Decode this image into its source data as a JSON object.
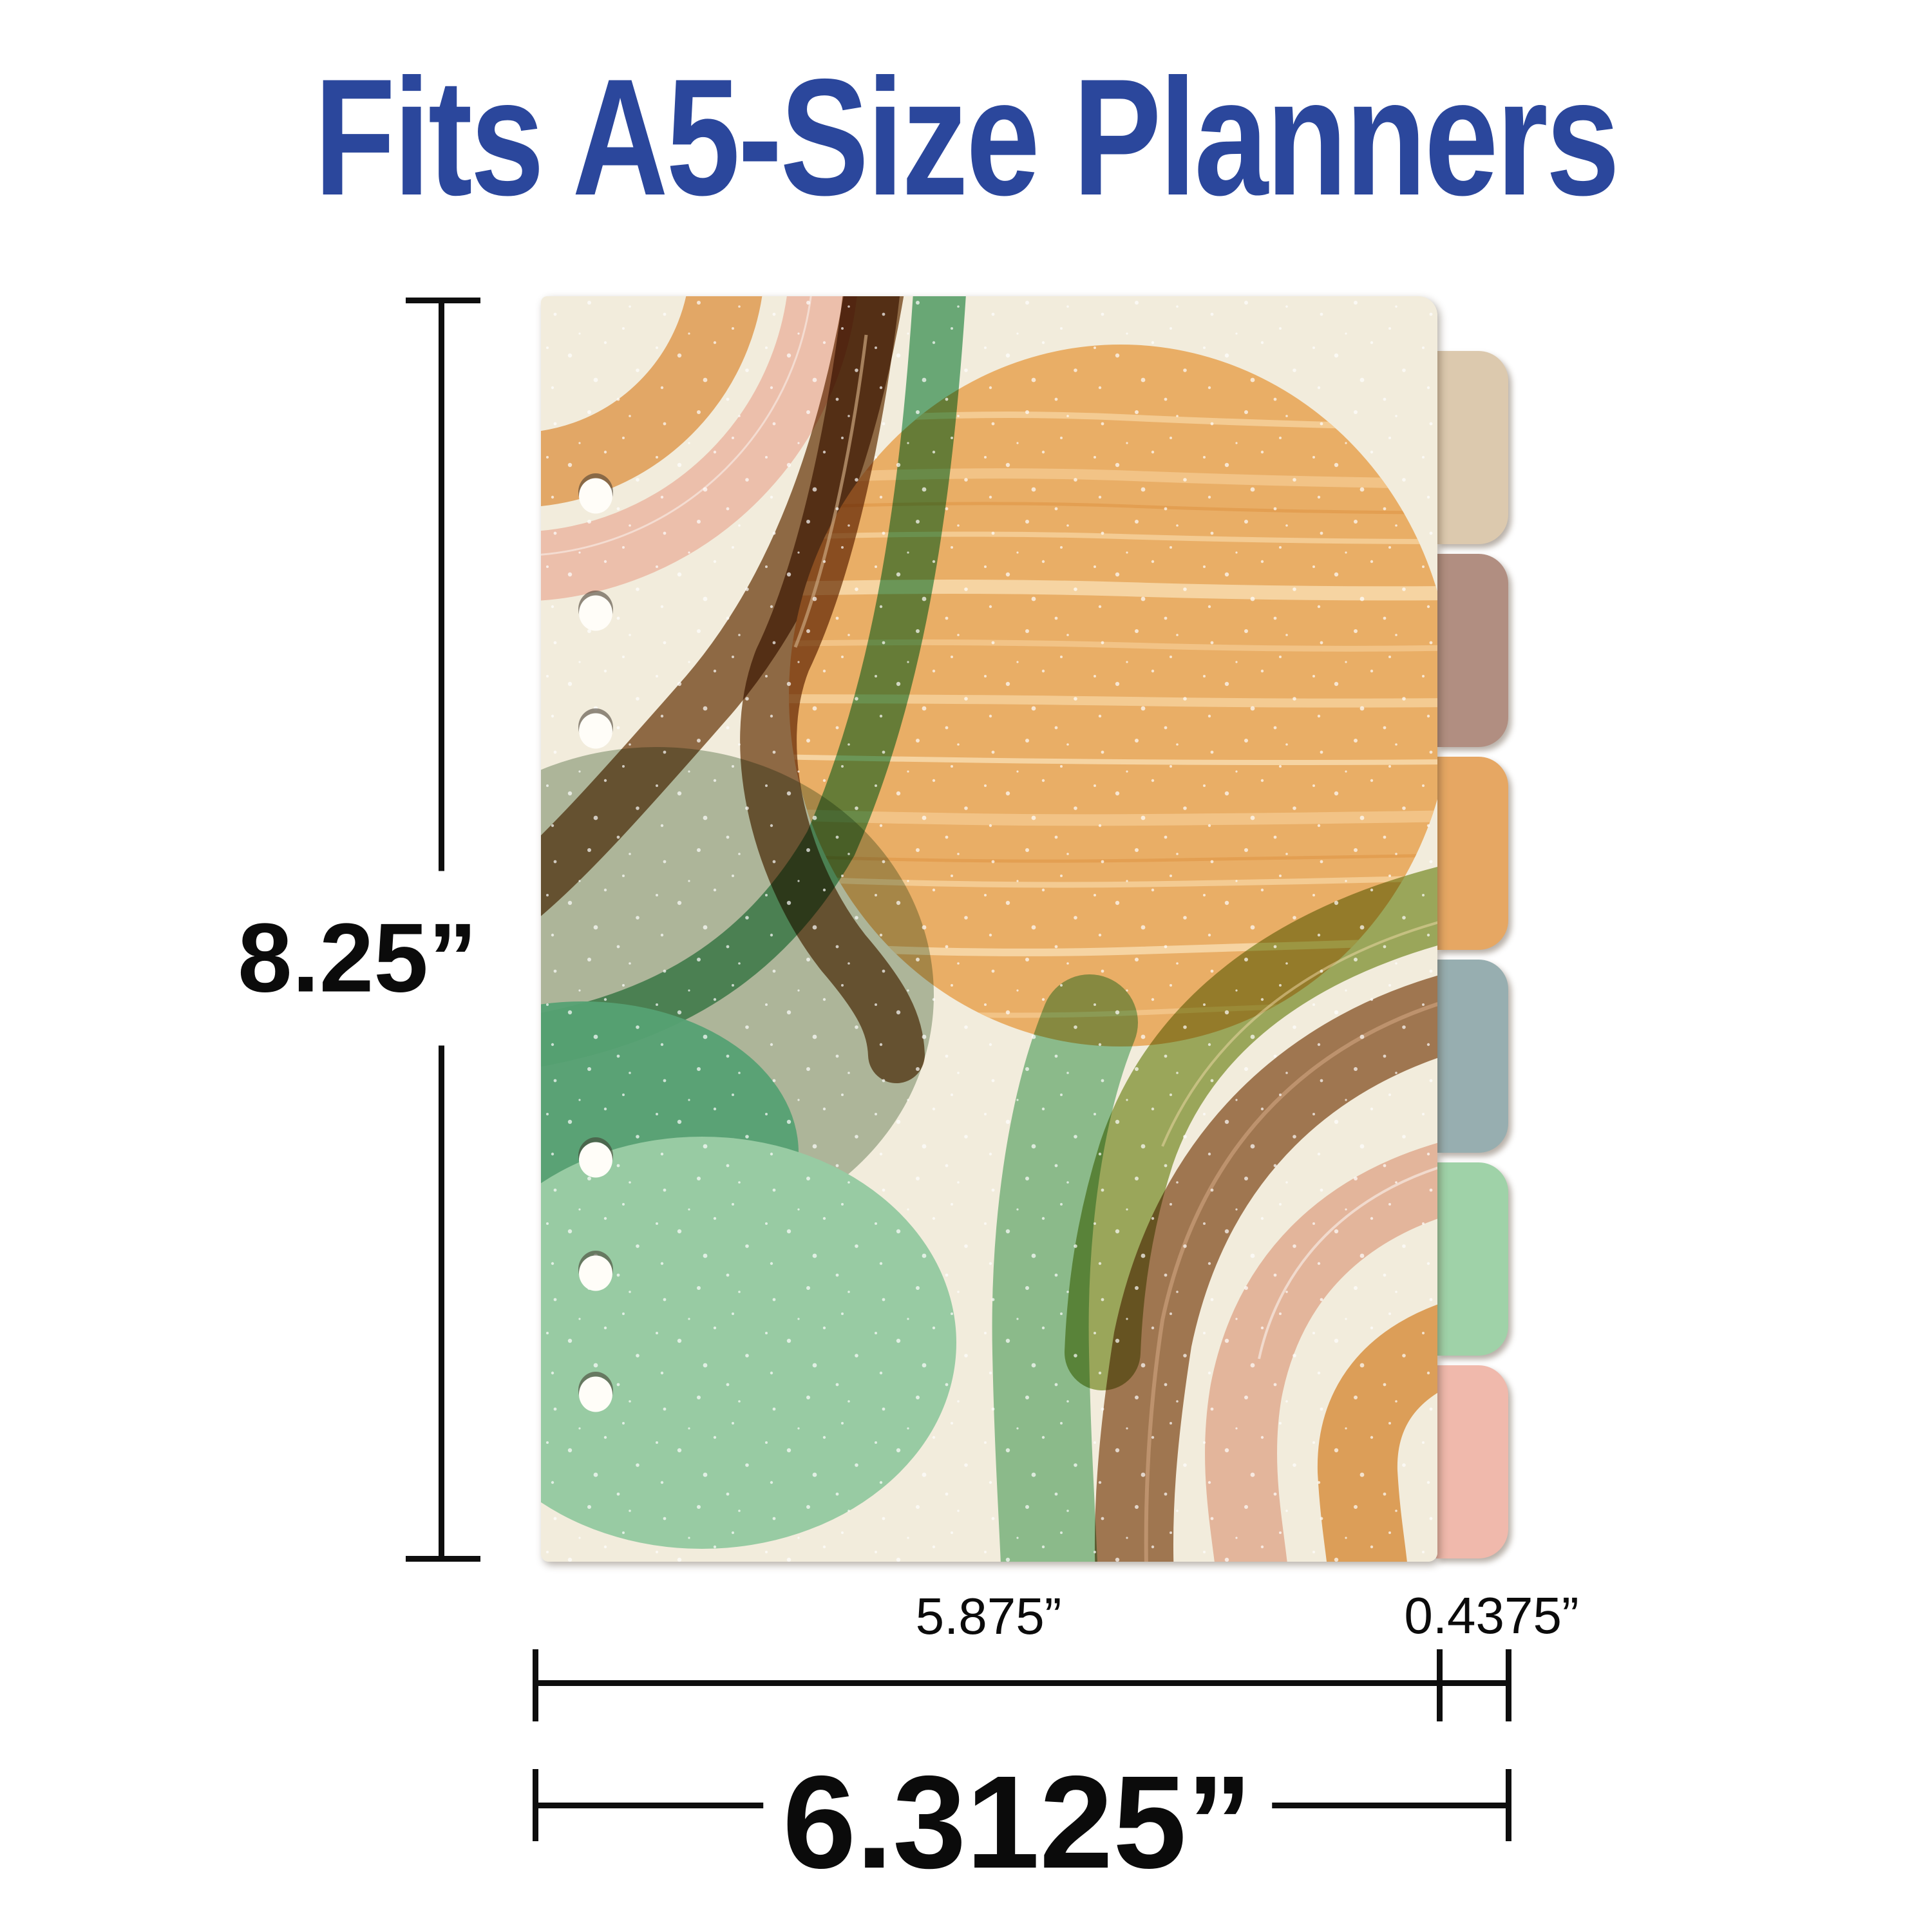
{
  "title": {
    "text": "Fits A5-Size Planners",
    "color": "#2b479c"
  },
  "dimensions": {
    "height_label": "8.25”",
    "body_width_label": "5.875”",
    "tab_width_label": "0.4375”",
    "total_width_label": "6.3125”",
    "line_color": "#0e0e0e"
  },
  "divider": {
    "description": "A5 planner divider sheet with abstract boho rainbow artwork, 6 binder holes and 6 colored edge tabs",
    "hole_count": 6,
    "tab_count": 6,
    "tabs": [
      {
        "name": "tab-1",
        "color": "#dcc9ae"
      },
      {
        "name": "tab-2",
        "color": "#b18e81"
      },
      {
        "name": "tab-3",
        "color": "#e6a763"
      },
      {
        "name": "tab-4",
        "color": "#97aeb0"
      },
      {
        "name": "tab-5",
        "color": "#9fd2a8"
      },
      {
        "name": "tab-6",
        "color": "#f0b9ac"
      }
    ],
    "artwork_palette": {
      "cream_background": "#f2ecdc",
      "orange_blob": "#e9ae66",
      "orange_streak": "#f6d4a2",
      "pink_arc": "#ecbfab",
      "brown_stroke": "#96714e",
      "teal_circle": "#b6c4b2",
      "sea_green_stroke": "#6fb588",
      "dark_green_blob": "#55a173",
      "light_green_blob": "#98cba3",
      "olive_arc": "#a2b468",
      "bottom_brown_arc": "#a87f5c",
      "bottom_pink_arc": "#f0c4b4",
      "bottom_orange_arc": "#e8ab66",
      "speckle": "#ffffff"
    }
  }
}
